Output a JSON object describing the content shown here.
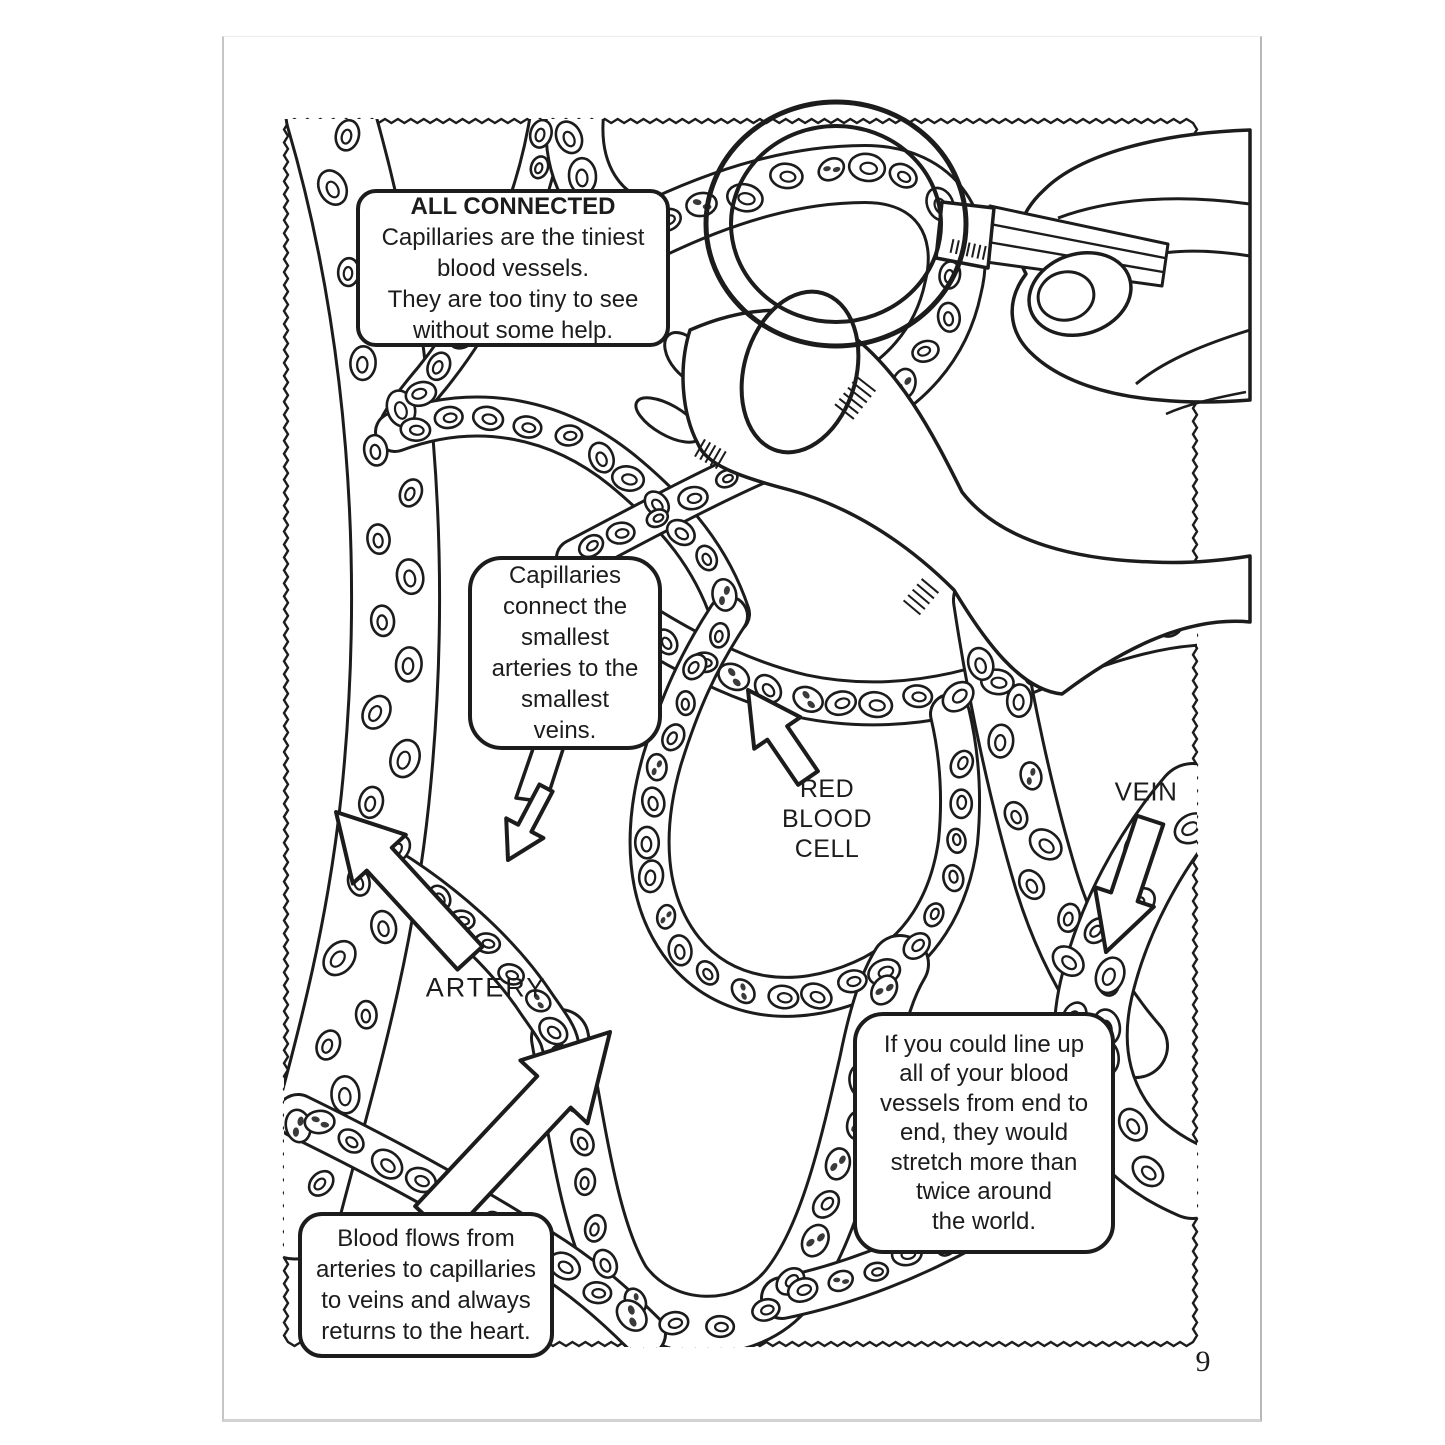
{
  "page": {
    "number": "9"
  },
  "callouts": {
    "all_connected": {
      "title": "ALL CONNECTED",
      "body": "Capillaries are the tiniest\nblood vessels.\nThey are too tiny to see\nwithout some help."
    },
    "capillaries_connect": {
      "body": "Capillaries\nconnect the\nsmallest\narteries to the\nsmallest\nveins."
    },
    "line_up": {
      "body": "If you could line up\nall of your blood\nvessels from end to\nend, they would\nstretch more than\ntwice around\nthe world."
    },
    "blood_flows": {
      "body": "Blood flows from\narteries to capillaries\nto veins and always\nreturns to the heart."
    }
  },
  "labels": {
    "red_blood_cell": "RED\nBLOOD\nCELL",
    "vein": "VEIN",
    "artery": "ARTERY"
  },
  "illustration": {
    "elements": [
      "zigzag-border",
      "capillary-network",
      "red-blood-cells",
      "foot",
      "examining-hand",
      "magnifying-glass",
      "artery-arrow",
      "vein-arrow",
      "red-blood-cell-arrow",
      "blood-flow-arrow",
      "speech-bubble-tail"
    ]
  },
  "colors": {
    "ink": "#1c1c1c",
    "paper": "#ffffff",
    "page_edge": "#c6c6c6"
  }
}
